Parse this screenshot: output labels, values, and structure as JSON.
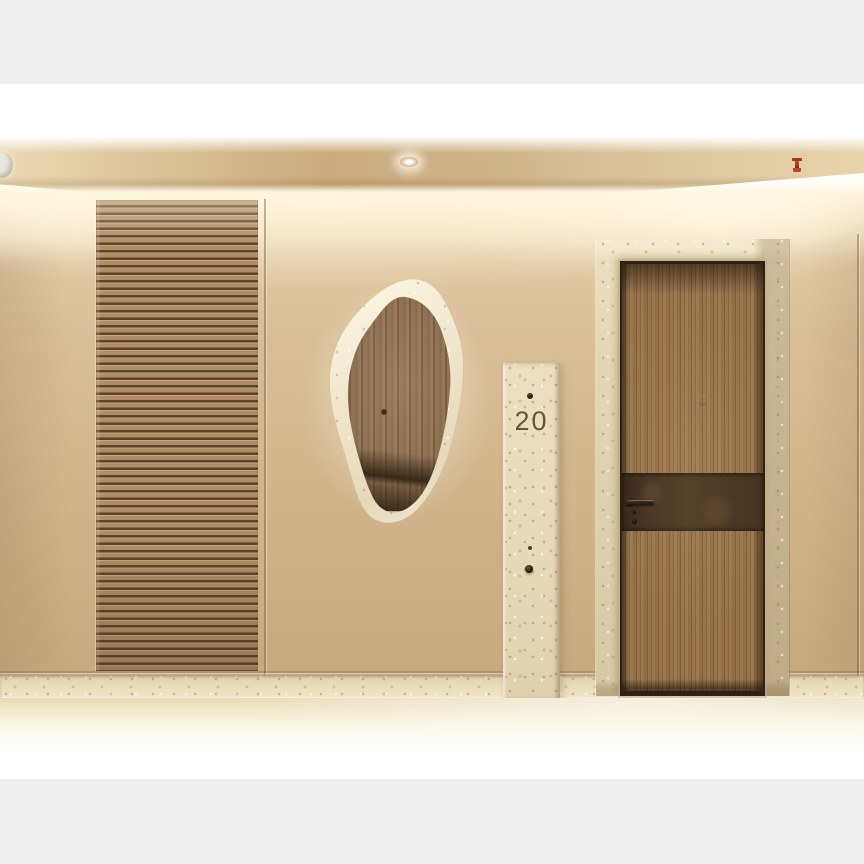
{
  "meta": {
    "title": "Corridor interior render",
    "description": "Beige textured corridor wall with horizontal wood-slat panel, backlit organic-shaped mirror, travertine number plaque and walnut entrance door with bronze band"
  },
  "plaque": {
    "number": "20"
  },
  "palette": {
    "page_background": "#efefef",
    "photo_white": "#ffffff",
    "ceiling": "#d5bb92",
    "wall_top": "#f3e3c0",
    "wall_bottom": "#c7a981",
    "slat_wood": "#b08d66",
    "slat_gap": "#5c432b",
    "mirror_rim": "#f2e9d3",
    "mirror_wood": "#84684a",
    "plaque_stone": "#e8dcbe",
    "plaque_number_color": "#6c5333",
    "door_frame_stone": "#e2d3b2",
    "door_wood": "#8f6d46",
    "door_band_bronze": "#4e3a26",
    "floor": "#ecdfc0",
    "sprinkler_red": "#b03e25"
  },
  "fixtures": {
    "sprinkler": "fire-sprinkler",
    "spotlight": "recessed-spotlight",
    "downlight": "ceiling-downlight"
  }
}
